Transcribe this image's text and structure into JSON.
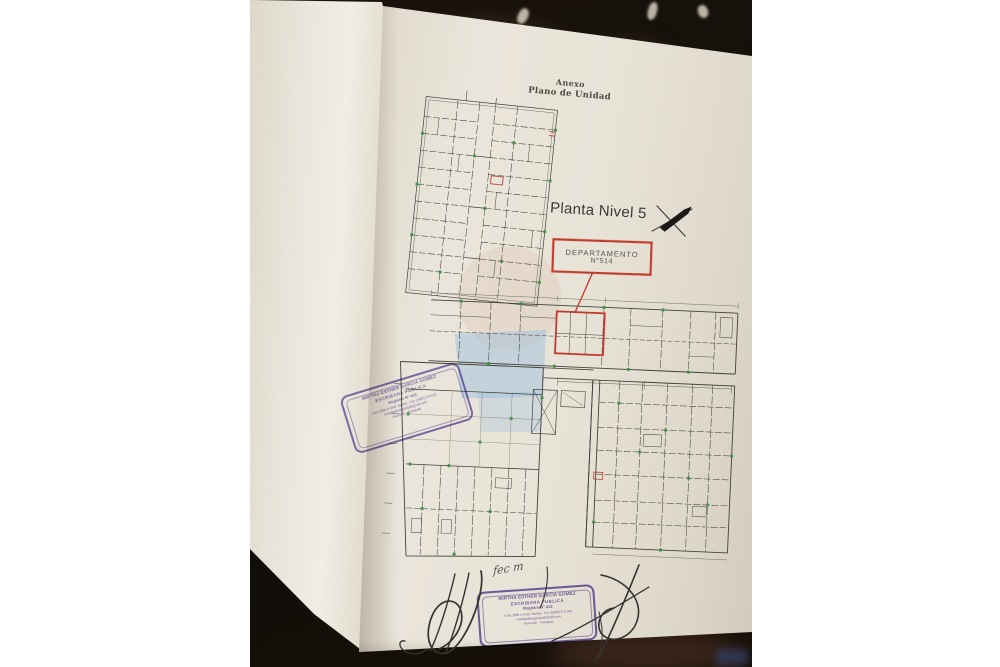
{
  "photo": {
    "document": {
      "header_line1": "Anexo",
      "header_line2": "Plano de Unidad",
      "plan_title": "Planta Nivel 5",
      "callout_line1": "DEPARTAMENTO",
      "callout_line2": "N°514",
      "handwritten_note": "fec m"
    },
    "stamp": {
      "name": "MIRTHA ESTHER GARCIA GOMEZ",
      "title": "ESCRIBANA PUBLICA",
      "registry": "Registro N° 413",
      "contact": "Cura 1886 c/ Gral. Santos - Cel: (0982) 973 642",
      "email": "mirthaesthergarcia@gmail.com",
      "location": "Asunción - Paraguay"
    },
    "colors": {
      "page": "#e8e3d7",
      "plan_line": "#3f4339",
      "highlight_red": "#c23b2f",
      "marker_green": "#3f8f44",
      "watermark_blue": "#9fc0dd",
      "stamp_purple": "#6e5cb0",
      "ink": "#35332e"
    }
  }
}
